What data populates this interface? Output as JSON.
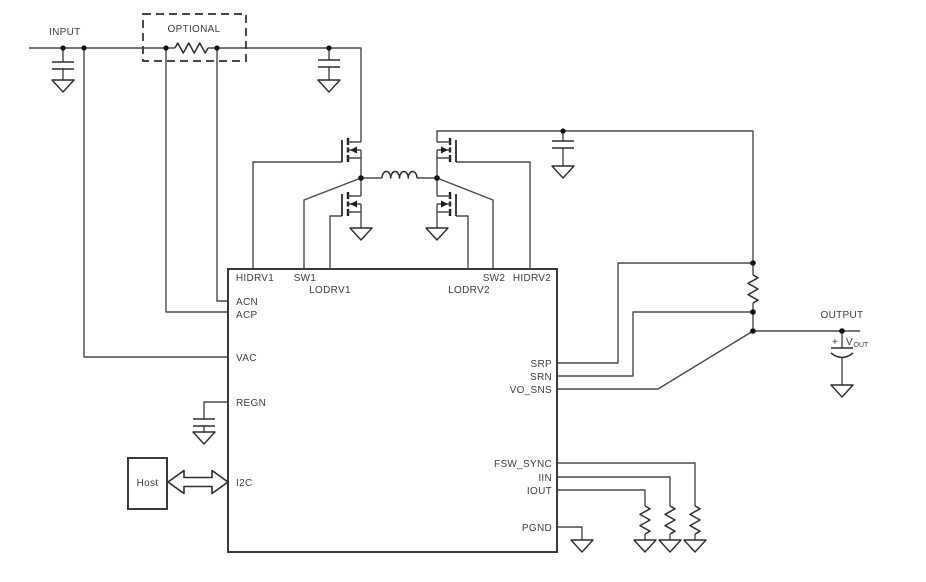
{
  "labels": {
    "input": "INPUT",
    "optional": "OPTIONAL",
    "output": "OUTPUT",
    "host": "Host",
    "vout_plus": "+",
    "vout_v": "V",
    "vout_sub": "OUT"
  },
  "ic": {
    "pins": {
      "top": [
        "HIDRV1",
        "SW1",
        "LODRV1",
        "LODRV2",
        "SW2",
        "HIDRV2"
      ],
      "left": [
        "ACN",
        "ACP",
        "VAC",
        "REGN",
        "I2C"
      ],
      "right": [
        "SRP",
        "SRN",
        "VO_SNS",
        "FSW_SYNC",
        "IIN",
        "IOUT",
        "PGND"
      ]
    }
  },
  "colors": {
    "background": "#ffffff",
    "wire": "#4a4a4a",
    "component": "#2f2f2f",
    "text": "#404040"
  }
}
